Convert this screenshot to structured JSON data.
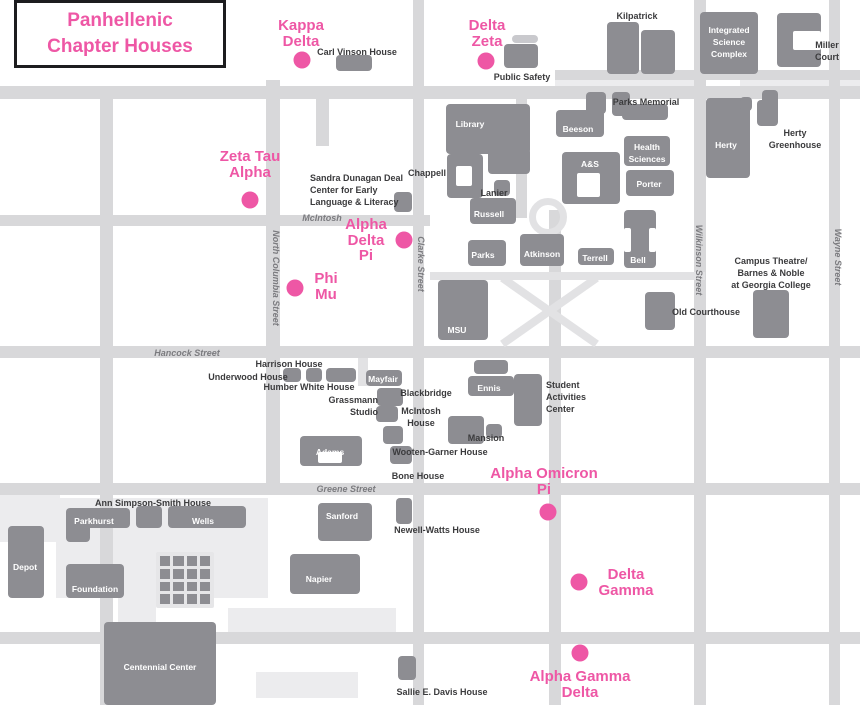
{
  "title": {
    "line1": "Panhellenic",
    "line2": "Chapter Houses"
  },
  "colors": {
    "pink": "#ee57a5",
    "building_gray": "#8d8d92",
    "street_gray": "#d8d8da",
    "dark_text": "#3b3b3d",
    "street_text": "#7b7b7f"
  },
  "chapters": [
    {
      "name": "Kappa Delta",
      "lines": [
        "Kappa",
        "Delta"
      ],
      "label": [
        301,
        18
      ],
      "dot": [
        302,
        60
      ]
    },
    {
      "name": "Delta Zeta",
      "lines": [
        "Delta",
        "Zeta"
      ],
      "label": [
        487,
        18
      ],
      "dot": [
        486,
        61
      ]
    },
    {
      "name": "Zeta Tau Alpha",
      "lines": [
        "Zeta Tau",
        "Alpha"
      ],
      "label": [
        250,
        149
      ],
      "dot": [
        250,
        200
      ]
    },
    {
      "name": "Alpha Delta Pi",
      "lines": [
        "Alpha",
        "Delta",
        "Pi"
      ],
      "label": [
        366,
        217
      ],
      "dot": [
        404,
        240
      ]
    },
    {
      "name": "Phi Mu",
      "lines": [
        "Phi",
        "Mu"
      ],
      "label": [
        326,
        271
      ],
      "dot": [
        295,
        288
      ]
    },
    {
      "name": "Alpha Omicron Pi",
      "lines": [
        "Alpha Omicron",
        "Pi"
      ],
      "label": [
        544,
        466
      ],
      "dot": [
        548,
        512
      ]
    },
    {
      "name": "Delta Gamma",
      "lines": [
        "Delta",
        "Gamma"
      ],
      "label": [
        626,
        567
      ],
      "dot": [
        579,
        582
      ]
    },
    {
      "name": "Alpha Gamma Delta",
      "lines": [
        "Alpha Gamma",
        "Delta"
      ],
      "label": [
        580,
        669
      ],
      "dot": [
        580,
        653
      ]
    }
  ],
  "street_labels": [
    {
      "text": "Hancock Street",
      "x": 187,
      "y": 348,
      "vertical": false
    },
    {
      "text": "Greene Street",
      "x": 346,
      "y": 484,
      "vertical": false
    },
    {
      "text": "McIntosh",
      "x": 322,
      "y": 213,
      "vertical": false
    },
    {
      "text": "North Columbia Street",
      "x": 276,
      "y": 278,
      "vertical": true
    },
    {
      "text": "Clarke Street",
      "x": 421,
      "y": 264,
      "vertical": true
    },
    {
      "text": "Wilkinson Street",
      "x": 699,
      "y": 260,
      "vertical": true
    },
    {
      "text": "Wayne Street",
      "x": 838,
      "y": 257,
      "vertical": true
    }
  ],
  "dark_labels": [
    {
      "lines": [
        "Carl Vinson House"
      ],
      "x": 357,
      "y": 46,
      "align": "center"
    },
    {
      "lines": [
        "Public Safety"
      ],
      "x": 522,
      "y": 71,
      "align": "center"
    },
    {
      "lines": [
        "Kilpatrick"
      ],
      "x": 637,
      "y": 10,
      "align": "center"
    },
    {
      "lines": [
        "Miller Court"
      ],
      "x": 827,
      "y": 39,
      "align": "center"
    },
    {
      "lines": [
        "Parks Memorial"
      ],
      "x": 646,
      "y": 96,
      "align": "center"
    },
    {
      "lines": [
        "Herty Greenhouse"
      ],
      "x": 795,
      "y": 127,
      "align": "center"
    },
    {
      "lines": [
        "Chappell"
      ],
      "x": 427,
      "y": 167,
      "align": "center"
    },
    {
      "lines": [
        "Lanier"
      ],
      "x": 494,
      "y": 187,
      "align": "center"
    },
    {
      "lines": [
        "Sandra Dunagan Deal",
        "Center for Early",
        "Language & Literacy"
      ],
      "x": 310,
      "y": 172,
      "align": "left"
    },
    {
      "lines": [
        "Old Courthouse"
      ],
      "x": 706,
      "y": 306,
      "align": "center"
    },
    {
      "lines": [
        "Campus Theatre/",
        "Barnes & Noble",
        "at Georgia College"
      ],
      "x": 771,
      "y": 255,
      "align": "center"
    },
    {
      "lines": [
        "Harrison House"
      ],
      "x": 289,
      "y": 358,
      "align": "center"
    },
    {
      "lines": [
        "Underwood House"
      ],
      "x": 248,
      "y": 371,
      "align": "center"
    },
    {
      "lines": [
        "Humber White House"
      ],
      "x": 309,
      "y": 381,
      "align": "center"
    },
    {
      "lines": [
        "Blackbridge"
      ],
      "x": 426,
      "y": 387,
      "align": "center"
    },
    {
      "lines": [
        "Grassmann",
        "Studio"
      ],
      "x": 378,
      "y": 394,
      "align": "right"
    },
    {
      "lines": [
        "McIntosh",
        "House"
      ],
      "x": 421,
      "y": 405,
      "align": "center"
    },
    {
      "lines": [
        "Mansion"
      ],
      "x": 486,
      "y": 432,
      "align": "center"
    },
    {
      "lines": [
        "Wooten-Garner House"
      ],
      "x": 440,
      "y": 446,
      "align": "center"
    },
    {
      "lines": [
        "Bone House"
      ],
      "x": 418,
      "y": 470,
      "align": "center"
    },
    {
      "lines": [
        "Student",
        "Activities",
        "Center"
      ],
      "x": 546,
      "y": 379,
      "align": "left"
    },
    {
      "lines": [
        "Ann Simpson-Smith House"
      ],
      "x": 153,
      "y": 497,
      "align": "center"
    },
    {
      "lines": [
        "Newell-Watts House"
      ],
      "x": 437,
      "y": 524,
      "align": "center"
    },
    {
      "lines": [
        "Sallie E. Davis House"
      ],
      "x": 442,
      "y": 686,
      "align": "center"
    }
  ],
  "white_labels": [
    {
      "lines": [
        "Library"
      ],
      "x": 470,
      "y": 118
    },
    {
      "lines": [
        "Beeson"
      ],
      "x": 578,
      "y": 123
    },
    {
      "lines": [
        "A&S"
      ],
      "x": 590,
      "y": 158
    },
    {
      "lines": [
        "Health",
        "Sciences"
      ],
      "x": 647,
      "y": 141
    },
    {
      "lines": [
        "Porter"
      ],
      "x": 649,
      "y": 178
    },
    {
      "lines": [
        "Herty"
      ],
      "x": 726,
      "y": 139
    },
    {
      "lines": [
        "Integrated",
        "Science",
        "Complex"
      ],
      "x": 729,
      "y": 24
    },
    {
      "lines": [
        "Russell"
      ],
      "x": 489,
      "y": 208
    },
    {
      "lines": [
        "Parks"
      ],
      "x": 483,
      "y": 249
    },
    {
      "lines": [
        "Atkinson"
      ],
      "x": 542,
      "y": 248
    },
    {
      "lines": [
        "Terrell"
      ],
      "x": 595,
      "y": 252
    },
    {
      "lines": [
        "Bell"
      ],
      "x": 638,
      "y": 254
    },
    {
      "lines": [
        "MSU"
      ],
      "x": 457,
      "y": 324
    },
    {
      "lines": [
        "Mayfair"
      ],
      "x": 383,
      "y": 373
    },
    {
      "lines": [
        "Ennis"
      ],
      "x": 489,
      "y": 382
    },
    {
      "lines": [
        "Adams"
      ],
      "x": 330,
      "y": 446
    },
    {
      "lines": [
        "Parkhurst"
      ],
      "x": 94,
      "y": 515
    },
    {
      "lines": [
        "Wells"
      ],
      "x": 203,
      "y": 515
    },
    {
      "lines": [
        "Depot"
      ],
      "x": 25,
      "y": 561
    },
    {
      "lines": [
        "Foundation"
      ],
      "x": 95,
      "y": 583
    },
    {
      "lines": [
        "Sanford"
      ],
      "x": 342,
      "y": 510
    },
    {
      "lines": [
        "Napier"
      ],
      "x": 319,
      "y": 573
    },
    {
      "lines": [
        "Centennial Center"
      ],
      "x": 160,
      "y": 661
    }
  ],
  "map": {
    "streets": [
      [
        0,
        86,
        860,
        13
      ],
      [
        555,
        70,
        305,
        10
      ],
      [
        0,
        215,
        430,
        11
      ],
      [
        0,
        346,
        860,
        12
      ],
      [
        0,
        483,
        860,
        12
      ],
      [
        0,
        632,
        860,
        12
      ],
      [
        100,
        86,
        13,
        619
      ],
      [
        266,
        80,
        14,
        405
      ],
      [
        413,
        0,
        11,
        705
      ],
      [
        516,
        88,
        11,
        130
      ],
      [
        549,
        210,
        12,
        495
      ],
      [
        694,
        0,
        12,
        705
      ],
      [
        829,
        0,
        11,
        705
      ],
      [
        316,
        86,
        13,
        60
      ]
    ],
    "paths": [
      [
        430,
        272,
        275,
        8
      ],
      [
        358,
        358,
        10,
        28
      ]
    ],
    "plazas": [
      [
        56,
        498,
        212,
        100
      ],
      [
        228,
        608,
        168,
        36
      ],
      [
        256,
        672,
        102,
        26
      ],
      [
        118,
        596,
        38,
        50
      ],
      [
        0,
        484,
        60,
        58
      ],
      [
        740,
        78,
        120,
        14
      ],
      [
        555,
        78,
        150,
        12
      ]
    ],
    "diagonals": [
      {
        "x": 492,
        "y": 307,
        "w": 115,
        "h": 8,
        "r": 35
      },
      {
        "x": 492,
        "y": 307,
        "w": 115,
        "h": 8,
        "r": -35
      }
    ],
    "roundabout": {
      "x": 529,
      "y": 198,
      "d": 24
    },
    "buildings": [
      [
        336,
        55,
        36,
        16
      ],
      [
        504,
        44,
        34,
        24
      ],
      [
        512,
        35,
        26,
        8,
        1
      ],
      [
        607,
        22,
        32,
        52
      ],
      [
        641,
        30,
        34,
        44
      ],
      [
        700,
        12,
        58,
        62
      ],
      [
        777,
        13,
        44,
        54
      ],
      [
        622,
        104,
        46,
        16
      ],
      [
        586,
        92,
        20,
        22
      ],
      [
        612,
        92,
        18,
        24
      ],
      [
        446,
        104,
        84,
        50
      ],
      [
        488,
        148,
        42,
        26
      ],
      [
        556,
        110,
        48,
        27
      ],
      [
        624,
        136,
        46,
        30
      ],
      [
        562,
        152,
        58,
        52
      ],
      [
        626,
        170,
        48,
        26
      ],
      [
        706,
        98,
        44,
        80
      ],
      [
        757,
        100,
        21,
        26
      ],
      [
        447,
        154,
        36,
        44
      ],
      [
        470,
        198,
        46,
        26
      ],
      [
        494,
        180,
        16,
        16
      ],
      [
        468,
        240,
        38,
        26
      ],
      [
        520,
        234,
        44,
        32
      ],
      [
        578,
        248,
        36,
        17
      ],
      [
        624,
        210,
        32,
        58
      ],
      [
        438,
        280,
        50,
        60
      ],
      [
        645,
        292,
        30,
        38
      ],
      [
        753,
        290,
        36,
        48
      ],
      [
        394,
        192,
        18,
        20
      ],
      [
        740,
        97,
        12,
        14
      ],
      [
        762,
        90,
        16,
        22
      ],
      [
        283,
        368,
        18,
        14
      ],
      [
        306,
        368,
        16,
        14
      ],
      [
        326,
        368,
        30,
        14
      ],
      [
        366,
        370,
        36,
        16
      ],
      [
        377,
        388,
        26,
        18
      ],
      [
        376,
        406,
        22,
        16
      ],
      [
        383,
        426,
        20,
        18
      ],
      [
        300,
        436,
        62,
        30
      ],
      [
        390,
        446,
        22,
        18
      ],
      [
        474,
        360,
        34,
        14
      ],
      [
        468,
        376,
        46,
        20
      ],
      [
        514,
        374,
        28,
        52
      ],
      [
        448,
        416,
        36,
        28
      ],
      [
        486,
        424,
        16,
        14
      ],
      [
        8,
        526,
        36,
        72
      ],
      [
        66,
        508,
        64,
        20
      ],
      [
        66,
        516,
        24,
        26
      ],
      [
        168,
        506,
        78,
        22
      ],
      [
        136,
        506,
        26,
        22
      ],
      [
        66,
        564,
        58,
        34
      ],
      [
        318,
        503,
        54,
        38
      ],
      [
        290,
        554,
        70,
        40
      ],
      [
        396,
        498,
        16,
        26
      ],
      [
        104,
        622,
        112,
        83
      ],
      [
        398,
        656,
        18,
        24
      ]
    ],
    "cutouts": [
      [
        456,
        166,
        16,
        20
      ],
      [
        793,
        31,
        28,
        19
      ],
      [
        577,
        173,
        23,
        24
      ],
      [
        318,
        452,
        24,
        11
      ],
      [
        624,
        228,
        7,
        24
      ],
      [
        649,
        228,
        7,
        24
      ]
    ],
    "grid_building": {
      "x": 156,
      "y": 552,
      "w": 58,
      "h": 56,
      "rows": 4,
      "cols": 4
    }
  }
}
